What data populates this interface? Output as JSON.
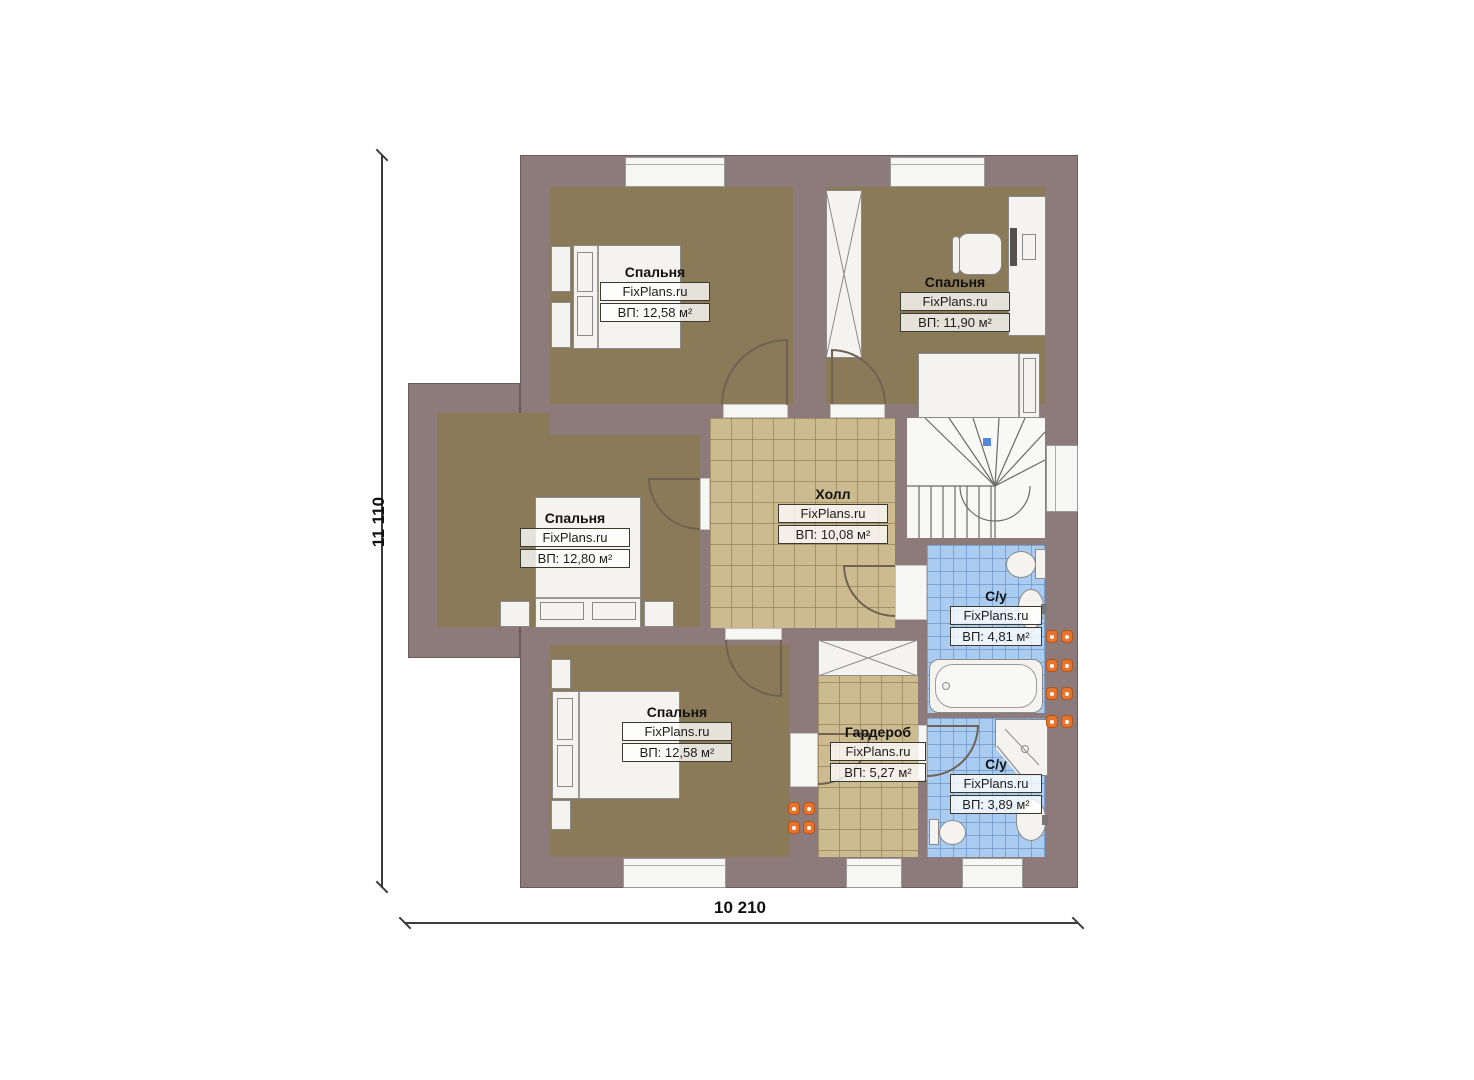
{
  "watermark": "FixPlans.ru",
  "dimensions": {
    "height_label": "11 110",
    "width_label": "10 210"
  },
  "rooms": [
    {
      "id": "bedroom-top-left",
      "name": "Спальня",
      "area": "ВП: 12,58 м²"
    },
    {
      "id": "bedroom-top-right",
      "name": "Спальня",
      "area": "ВП: 11,90 м²"
    },
    {
      "id": "bedroom-middle-left",
      "name": "Спальня",
      "area": "ВП: 12,80 м²"
    },
    {
      "id": "bedroom-bottom-left",
      "name": "Спальня",
      "area": "ВП: 12,58 м²"
    },
    {
      "id": "hall",
      "name": "Холл",
      "area": "ВП: 10,08 м²"
    },
    {
      "id": "wardrobe",
      "name": "Гардероб",
      "area": "ВП: 5,27 м²"
    },
    {
      "id": "bathroom-upper",
      "name": "С/у",
      "area": "ВП: 4,81 м²"
    },
    {
      "id": "bathroom-lower",
      "name": "С/у",
      "area": "ВП: 3,89 м²"
    }
  ],
  "colors": {
    "wall": "#8d7a7a",
    "bedroom_floor": "#8b7a58",
    "hall_floor": "#cdbb90",
    "bathroom_floor": "#a9ccf0",
    "radiator": "#e8732a"
  }
}
